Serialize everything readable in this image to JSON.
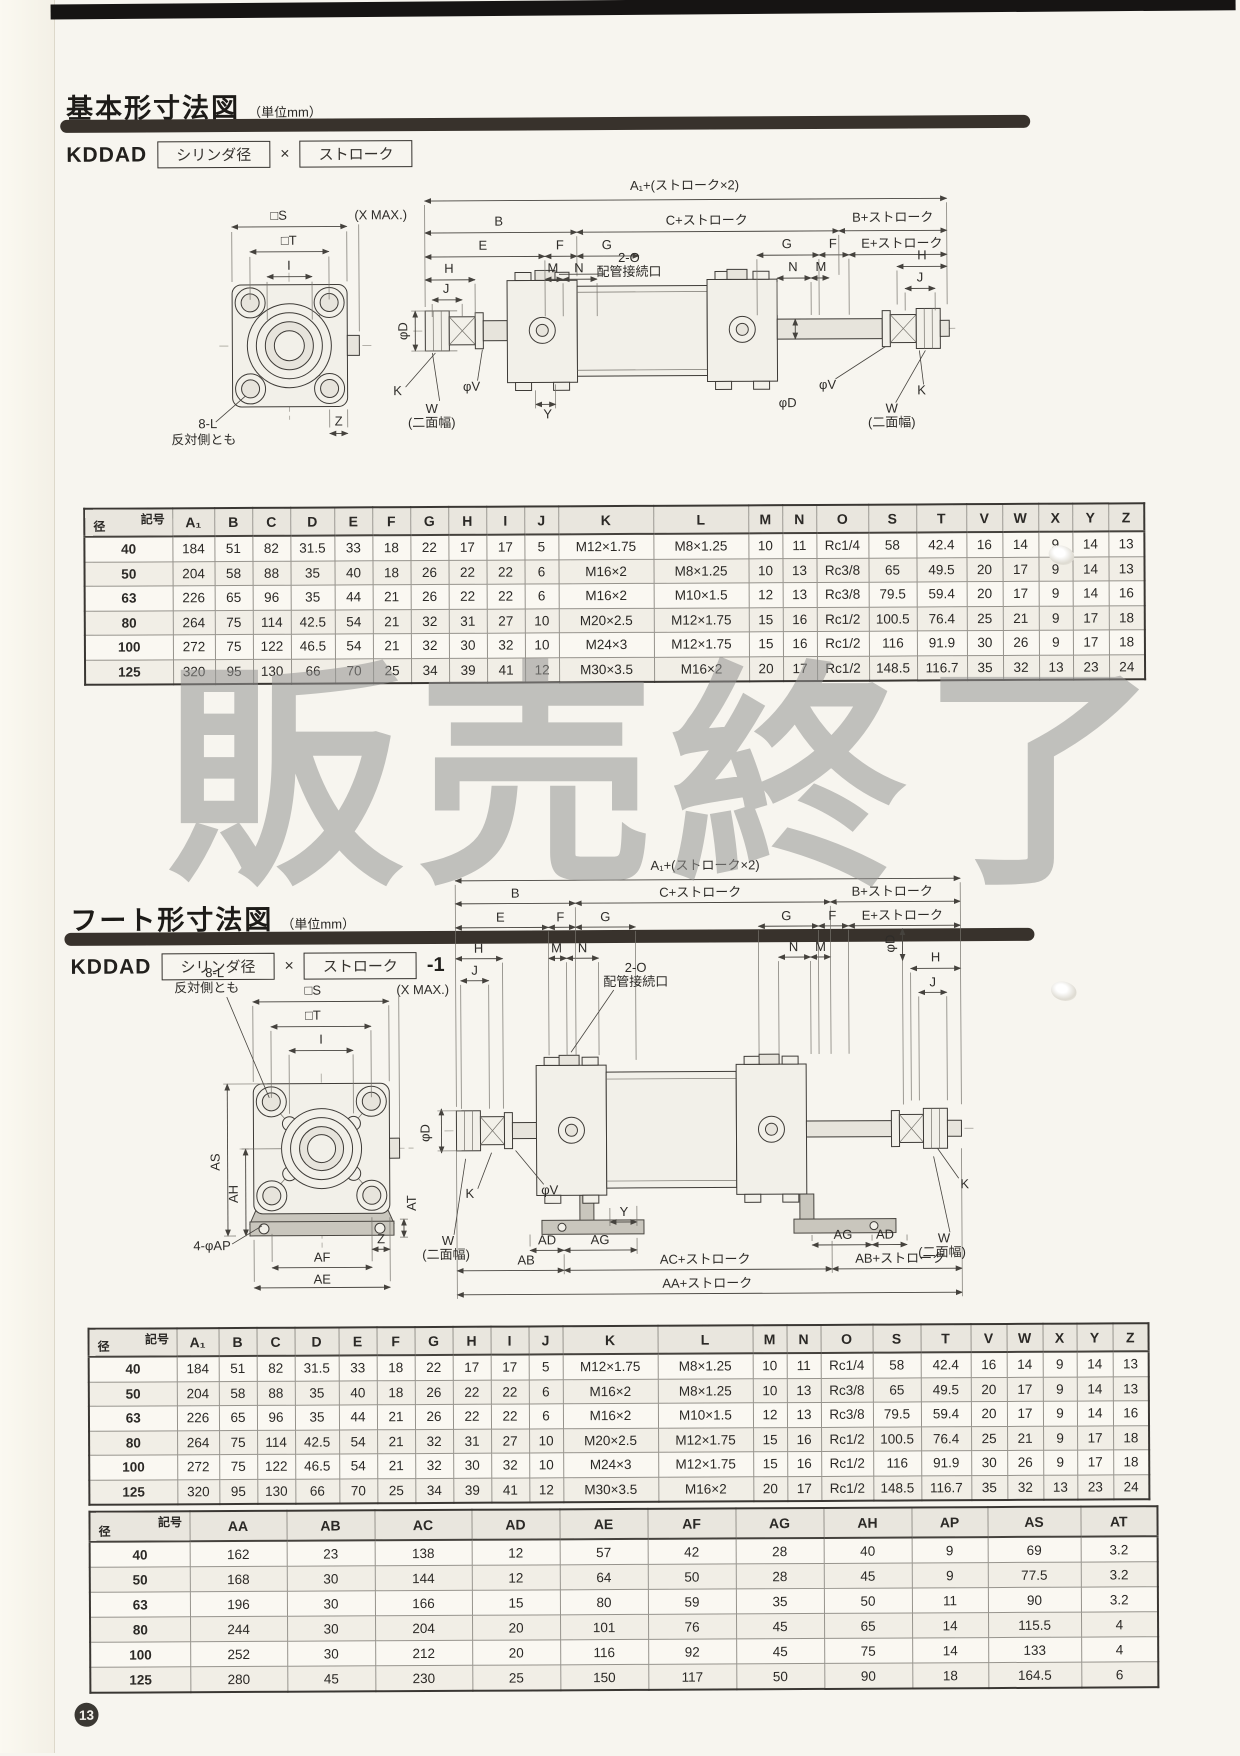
{
  "page": {
    "number": "13",
    "watermark": "販売終了"
  },
  "sections": {
    "basic": {
      "title": "基本形寸法図",
      "unit": "（単位mm）",
      "model_prefix": "KDDAD",
      "model_bore": "シリンダ径",
      "model_times": "×",
      "model_stroke": "ストローク",
      "model_suffix": ""
    },
    "foot": {
      "title": "フート形寸法図",
      "unit": "（単位mm）",
      "model_prefix": "KDDAD",
      "model_bore": "シリンダ径",
      "model_times": "×",
      "model_stroke": "ストローク",
      "model_suffix": "-1"
    }
  },
  "dim_labels": {
    "s": "□S",
    "xmax": "(X MAX.)",
    "t": "□T",
    "i": "I",
    "z": "Z",
    "l8": "8-L",
    "l8b": "反対側とも",
    "a1st": "A₁+(ストローク×2)",
    "b": "B",
    "cst": "C+ストローク",
    "bst": "B+ストローク",
    "e": "E",
    "f": "F",
    "g": "G",
    "est": "E+ストローク",
    "h": "H",
    "m": "M",
    "n": "N",
    "j": "J",
    "o2": "2-O",
    "pipe": "配管接続口",
    "phid": "φD",
    "phiv": "φV",
    "k": "K",
    "w": "W",
    "w2": "(二面幅)",
    "y": "Y",
    "as": "AS",
    "ah": "AH",
    "at": "AT",
    "ap4": "4-φAP",
    "af": "AF",
    "ae": "AE",
    "ad": "AD",
    "ag": "AG",
    "ab": "AB",
    "acst": "AC+ストローク",
    "abst": "AB+ストローク",
    "aast": "AA+ストローク"
  },
  "table_corner": {
    "top": "記号",
    "bottom": "径"
  },
  "table1": {
    "columns": [
      "A₁",
      "B",
      "C",
      "D",
      "E",
      "F",
      "G",
      "H",
      "I",
      "J",
      "K",
      "L",
      "M",
      "N",
      "O",
      "S",
      "T",
      "V",
      "W",
      "X",
      "Y",
      "Z"
    ],
    "rows": [
      {
        "dia": "40",
        "values": [
          "184",
          "51",
          "82",
          "31.5",
          "33",
          "18",
          "22",
          "17",
          "17",
          "5",
          "M12×1.75",
          "M8×1.25",
          "10",
          "11",
          "Rc1/4",
          "58",
          "42.4",
          "16",
          "14",
          "9",
          "14",
          "13"
        ]
      },
      {
        "dia": "50",
        "values": [
          "204",
          "58",
          "88",
          "35",
          "40",
          "18",
          "26",
          "22",
          "22",
          "6",
          "M16×2",
          "M8×1.25",
          "10",
          "13",
          "Rc3/8",
          "65",
          "49.5",
          "20",
          "17",
          "9",
          "14",
          "13"
        ]
      },
      {
        "dia": "63",
        "values": [
          "226",
          "65",
          "96",
          "35",
          "44",
          "21",
          "26",
          "22",
          "22",
          "6",
          "M16×2",
          "M10×1.5",
          "12",
          "13",
          "Rc3/8",
          "79.5",
          "59.4",
          "20",
          "17",
          "9",
          "14",
          "16"
        ]
      },
      {
        "dia": "80",
        "values": [
          "264",
          "75",
          "114",
          "42.5",
          "54",
          "21",
          "32",
          "31",
          "27",
          "10",
          "M20×2.5",
          "M12×1.75",
          "15",
          "16",
          "Rc1/2",
          "100.5",
          "76.4",
          "25",
          "21",
          "9",
          "17",
          "18"
        ]
      },
      {
        "dia": "100",
        "values": [
          "272",
          "75",
          "122",
          "46.5",
          "54",
          "21",
          "32",
          "30",
          "32",
          "10",
          "M24×3",
          "M12×1.75",
          "15",
          "16",
          "Rc1/2",
          "116",
          "91.9",
          "30",
          "26",
          "9",
          "17",
          "18"
        ]
      },
      {
        "dia": "125",
        "values": [
          "320",
          "95",
          "130",
          "66",
          "70",
          "25",
          "34",
          "39",
          "41",
          "12",
          "M30×3.5",
          "M16×2",
          "20",
          "17",
          "Rc1/2",
          "148.5",
          "116.7",
          "35",
          "32",
          "13",
          "23",
          "24"
        ]
      }
    ]
  },
  "table2": {
    "columns": [
      "A₁",
      "B",
      "C",
      "D",
      "E",
      "F",
      "G",
      "H",
      "I",
      "J",
      "K",
      "L",
      "M",
      "N",
      "O",
      "S",
      "T",
      "V",
      "W",
      "X",
      "Y",
      "Z"
    ],
    "rows": [
      {
        "dia": "40",
        "values": [
          "184",
          "51",
          "82",
          "31.5",
          "33",
          "18",
          "22",
          "17",
          "17",
          "5",
          "M12×1.75",
          "M8×1.25",
          "10",
          "11",
          "Rc1/4",
          "58",
          "42.4",
          "16",
          "14",
          "9",
          "14",
          "13"
        ]
      },
      {
        "dia": "50",
        "values": [
          "204",
          "58",
          "88",
          "35",
          "40",
          "18",
          "26",
          "22",
          "22",
          "6",
          "M16×2",
          "M8×1.25",
          "10",
          "13",
          "Rc3/8",
          "65",
          "49.5",
          "20",
          "17",
          "9",
          "14",
          "13"
        ]
      },
      {
        "dia": "63",
        "values": [
          "226",
          "65",
          "96",
          "35",
          "44",
          "21",
          "26",
          "22",
          "22",
          "6",
          "M16×2",
          "M10×1.5",
          "12",
          "13",
          "Rc3/8",
          "79.5",
          "59.4",
          "20",
          "17",
          "9",
          "14",
          "16"
        ]
      },
      {
        "dia": "80",
        "values": [
          "264",
          "75",
          "114",
          "42.5",
          "54",
          "21",
          "32",
          "31",
          "27",
          "10",
          "M20×2.5",
          "M12×1.75",
          "15",
          "16",
          "Rc1/2",
          "100.5",
          "76.4",
          "25",
          "21",
          "9",
          "17",
          "18"
        ]
      },
      {
        "dia": "100",
        "values": [
          "272",
          "75",
          "122",
          "46.5",
          "54",
          "21",
          "32",
          "30",
          "32",
          "10",
          "M24×3",
          "M12×1.75",
          "15",
          "16",
          "Rc1/2",
          "116",
          "91.9",
          "30",
          "26",
          "9",
          "17",
          "18"
        ]
      },
      {
        "dia": "125",
        "values": [
          "320",
          "95",
          "130",
          "66",
          "70",
          "25",
          "34",
          "39",
          "41",
          "12",
          "M30×3.5",
          "M16×2",
          "20",
          "17",
          "Rc1/2",
          "148.5",
          "116.7",
          "35",
          "32",
          "13",
          "23",
          "24"
        ]
      }
    ]
  },
  "table3": {
    "columns": [
      "AA",
      "AB",
      "AC",
      "AD",
      "AE",
      "AF",
      "AG",
      "AH",
      "AP",
      "AS",
      "AT"
    ],
    "rows": [
      {
        "dia": "40",
        "values": [
          "162",
          "23",
          "138",
          "12",
          "57",
          "42",
          "28",
          "40",
          "9",
          "69",
          "3.2"
        ]
      },
      {
        "dia": "50",
        "values": [
          "168",
          "30",
          "144",
          "12",
          "64",
          "50",
          "28",
          "45",
          "9",
          "77.5",
          "3.2"
        ]
      },
      {
        "dia": "63",
        "values": [
          "196",
          "30",
          "166",
          "15",
          "80",
          "59",
          "35",
          "50",
          "11",
          "90",
          "3.2"
        ]
      },
      {
        "dia": "80",
        "values": [
          "244",
          "30",
          "204",
          "20",
          "101",
          "76",
          "45",
          "65",
          "14",
          "115.5",
          "4"
        ]
      },
      {
        "dia": "100",
        "values": [
          "252",
          "30",
          "212",
          "20",
          "116",
          "92",
          "45",
          "75",
          "14",
          "133",
          "4"
        ]
      },
      {
        "dia": "125",
        "values": [
          "280",
          "45",
          "230",
          "25",
          "150",
          "117",
          "50",
          "90",
          "18",
          "164.5",
          "6"
        ]
      }
    ]
  }
}
